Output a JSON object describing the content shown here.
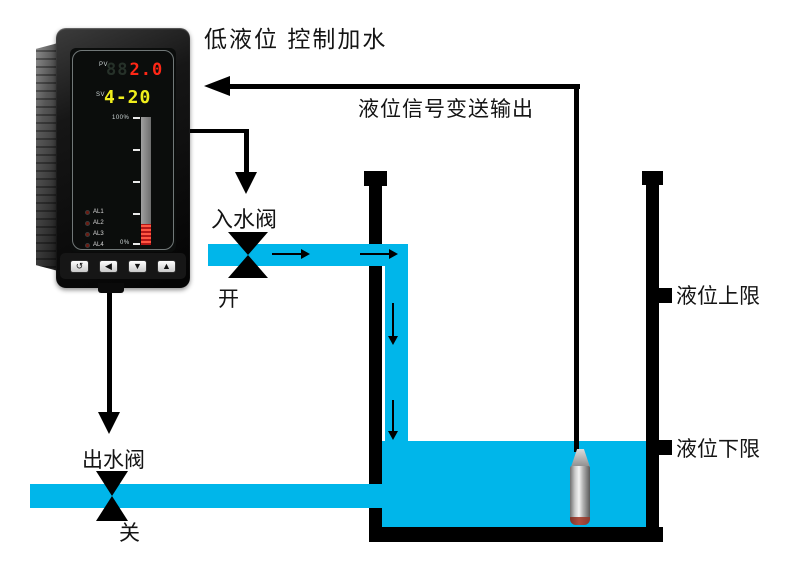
{
  "diagram": {
    "title": "低液位 控制加水",
    "signal_label": "液位信号变送输出",
    "inlet_valve": {
      "label": "入水阀",
      "state": "开"
    },
    "outlet_valve": {
      "label": "出水阀",
      "state": "关"
    },
    "tank": {
      "upper_limit": "液位上限",
      "lower_limit": "液位下限"
    }
  },
  "instrument": {
    "pv_label": "PV",
    "pv_ghost": "88",
    "pv_value": "2.0",
    "sv_label": "SV",
    "sv_value": "4-20",
    "bar_top": "100%",
    "bar_bottom": "0%",
    "leds": [
      "AL1",
      "AL2",
      "AL3",
      "AL4"
    ],
    "button_glyphs": [
      "↺",
      "◀",
      "▼",
      "▲"
    ]
  },
  "colors": {
    "water": "#00b6ea",
    "line_black": "#000000",
    "pv_red": "#ff2716",
    "sv_yellow": "#f0ee1c",
    "bar_red": "#d42a1e"
  }
}
